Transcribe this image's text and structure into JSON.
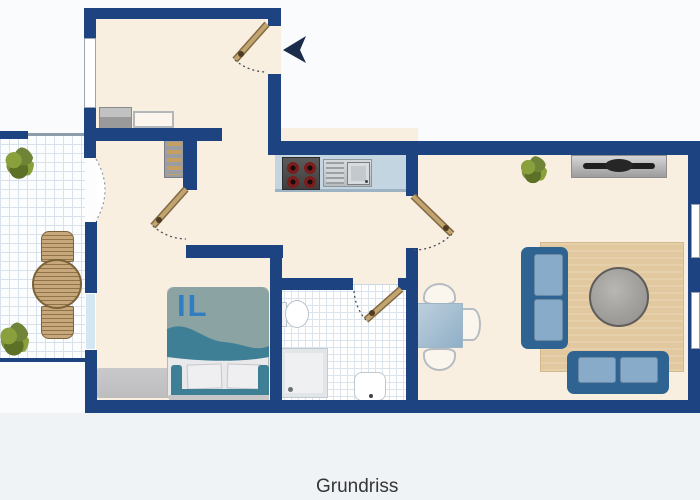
{
  "floorplan": {
    "title": "Grundriss",
    "watermark": "IL",
    "colors": {
      "wall": "#1d4381",
      "floor": "#f8efe1",
      "outside": "#fafbfd",
      "outside_lower": "#f0f3f6",
      "tile_grid": "#dbe4ec",
      "counter": "#c3d5e1",
      "wood": "#c2a470",
      "wood_dark": "#836a42",
      "steel": "#ccd1d4",
      "sofa_frame": "#2f6492",
      "sofa_cushion": "#87abc8",
      "living_rug": "#e2c89e",
      "bedroom_rug": "#bdbdbf",
      "coffee_table": "#a5a3a0",
      "dining_table": "#9db8cc",
      "blanket": "#8ba4a3",
      "blanket_wave": "#3f7f95",
      "pillow": "#efeff1",
      "arrow": "#1a2c49",
      "window_tint": "#d3e6f2",
      "label_color": "#363636",
      "watermark_color": "#2b7ac5"
    },
    "icons": {
      "entrance_arrow": "left-pointing-arrow",
      "door_swing": "dashed-quarter-arc"
    }
  }
}
